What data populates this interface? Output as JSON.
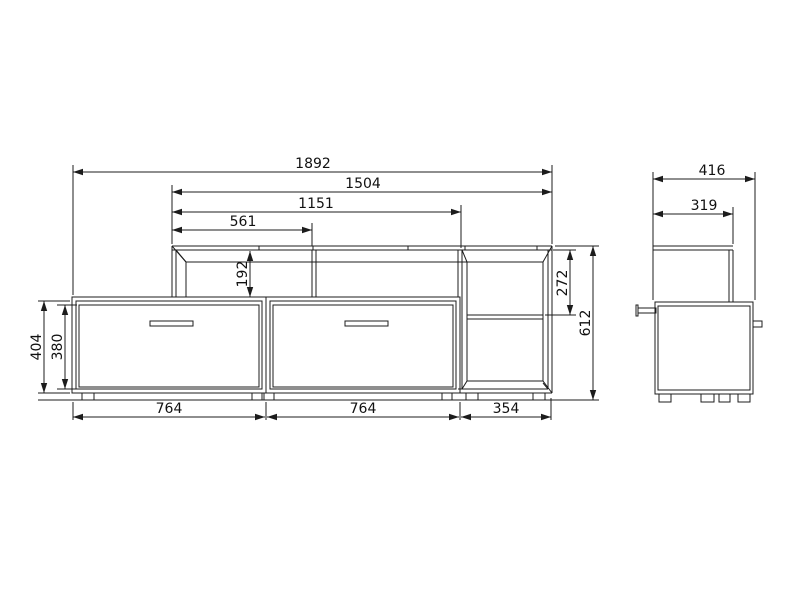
{
  "drawing": {
    "type": "furniture dimension drawing",
    "background": "#ffffff",
    "line_color": "#1c1c1c"
  },
  "views": {
    "front": {
      "label": "front elevation",
      "dims": {
        "overall_width_mm": "1892",
        "shelf_width_mm": "1504",
        "divider_right_mm": "1151",
        "divider_left_mm": "561",
        "shelf_opening_height_mm": "192",
        "niche_height_mm": "272",
        "overall_height_mm": "612",
        "base_height_mm": "404",
        "drawer_front_height_mm": "380",
        "drawer_left_width_mm": "764",
        "drawer_right_width_mm": "764",
        "open_section_width_mm": "354"
      }
    },
    "side": {
      "label": "side elevation",
      "dims": {
        "overall_depth_mm": "416",
        "shelf_depth_mm": "319"
      }
    }
  }
}
